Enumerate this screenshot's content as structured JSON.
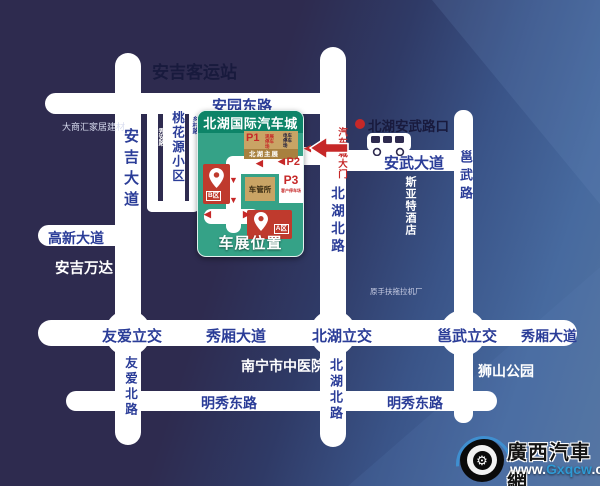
{
  "colors": {
    "background_dark": "#2e2b4f",
    "background_blue": "#54749f",
    "road": "#ffffff",
    "road_label_blue": "#2b3d98",
    "dark_text": "#181a3d",
    "venue_green": "#35a287",
    "venue_header_green": "#0d8468",
    "parking_tan": "#c9a465",
    "accent_red": "#c62828",
    "zone_box_red": "#bf3a2d"
  },
  "landmarks": {
    "anji_bus_station": "安吉客运站",
    "dashanghui": "大商汇家居建材",
    "taohuayuan": "桃花源小区",
    "anji_wanda": "安吉万达",
    "hospital": "南宁市中医院",
    "lion_park": "狮山公园",
    "tractor_factory": "原手扶拖拉机厂",
    "siyate_hotel": "斯亚特酒店",
    "beihu_anwu_junction": "北湖安武路口"
  },
  "roads": {
    "anyuan_east": "安园东路",
    "anji_avenue": "安吉大道",
    "gaoxin_avenue": "高新大道",
    "anwu_avenue": "安武大道",
    "yongwu_road": "邕武路",
    "beihu_north_upper": "北湖北路",
    "beihu_north_lower": "北湖北路",
    "youai_north": "友爱北路",
    "youai_interchange": "友爱立交",
    "xiuxiang_avenue_west": "秀厢大道",
    "beihu_interchange": "北湖立交",
    "yongwu_interchange": "邕武立交",
    "xiuxiang_avenue_east": "秀厢大道",
    "mingxiu_east_west": "明秀东路",
    "mingxiu_east_east": "明秀东路",
    "xiuan_lane": "秀安路",
    "xiangcun_lane": "乡村路"
  },
  "venue": {
    "title": "北湖国际汽车城",
    "caption": "车展位置",
    "gate_label": "汽车城大门",
    "p1_label": "P1",
    "p1_note": "观展停车场",
    "p2_label": "P2",
    "p2_note": "电车停车场",
    "main_hall": "北湖主展",
    "office": "车管所",
    "p3_label": "P3",
    "p3_note": "客户停车场",
    "zone_a": "A区",
    "zone_b": "B区"
  },
  "logo": {
    "site_name": "廣西汽車網",
    "url_www": "www.",
    "url_domain": "Gxqcw",
    "url_tld": ".com"
  }
}
